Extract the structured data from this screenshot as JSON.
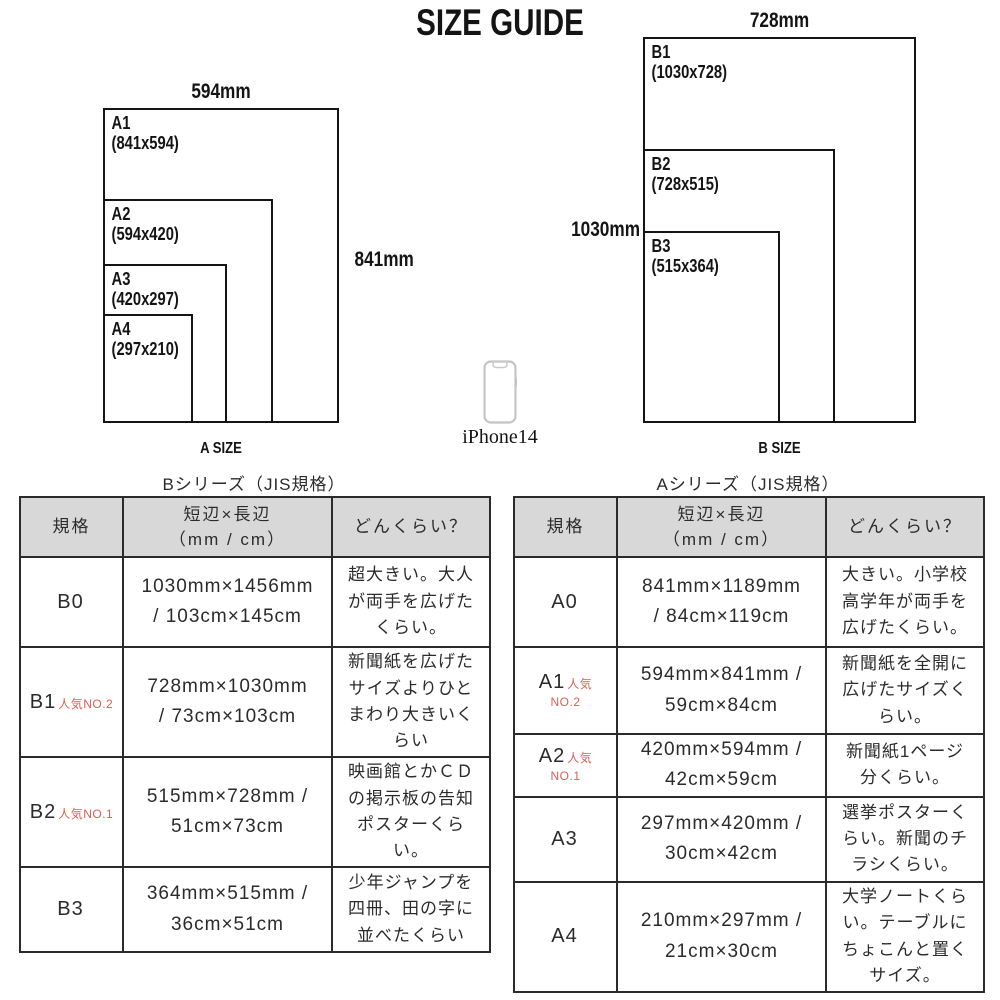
{
  "title": "SIZE GUIDE",
  "colors": {
    "accent_red": "#e05c53",
    "header_bg": "#d8d8d8",
    "border": "#2b2b2b",
    "ink": "#141414",
    "phone_gray": "#c4c4c4"
  },
  "a_diagram": {
    "width_label": "594mm",
    "height_label": "841mm",
    "caption": "A SIZE",
    "rects": [
      {
        "name": "A1",
        "dims": "(841x594)"
      },
      {
        "name": "A2",
        "dims": "(594x420)"
      },
      {
        "name": "A3",
        "dims": "(420x297)"
      },
      {
        "name": "A4",
        "dims": "(297x210)"
      }
    ]
  },
  "b_diagram": {
    "width_label": "728mm",
    "height_label": "1030mm",
    "caption": "B SIZE",
    "rects": [
      {
        "name": "B1",
        "dims": "(1030x728)"
      },
      {
        "name": "B2",
        "dims": "(728x515)"
      },
      {
        "name": "B3",
        "dims": "(515x364)"
      }
    ]
  },
  "phone": {
    "label": "iPhone14"
  },
  "tables": {
    "b": {
      "title": "Bシリーズ（JIS規格）",
      "headers": {
        "col1": "規格",
        "col2": "短辺×長辺\n（mm / cm）",
        "col3": "どんくらい？"
      },
      "rows": [
        {
          "label": "B0",
          "popular": "",
          "popular2": "",
          "size": "1030mm×1456mm\n/ 103cm×145cm",
          "desc": "超大きい。大人\nが両手を広げた\nくらい。"
        },
        {
          "label": "B1",
          "popular": "人気NO.2",
          "popular2": "",
          "size": "728mm×1030mm\n/ 73cm×103cm",
          "desc": "新聞紙を広げた\nサイズよりひと\nまわり大きいく\nらい"
        },
        {
          "label": "B2",
          "popular": "人気NO.1",
          "popular2": "",
          "size": "515mm×728mm /\n51cm×73cm",
          "desc": "映画館とかＣＤ\nの掲示板の告知\nポスターくら\nい。"
        },
        {
          "label": "B3",
          "popular": "",
          "popular2": "",
          "size": "364mm×515mm /\n36cm×51cm",
          "desc": "少年ジャンプを\n四冊、田の字に\n並べたくらい"
        }
      ]
    },
    "a": {
      "title": "Aシリーズ（JIS規格）",
      "headers": {
        "col1": "規格",
        "col2": "短辺×長辺\n（mm / cm）",
        "col3": "どんくらい？"
      },
      "rows": [
        {
          "label": "A0",
          "popular": "",
          "popular2": "",
          "size": "841mm×1189mm\n/ 84cm×119cm",
          "desc": "大きい。小学校\n高学年が両手を\n広げたくらい。"
        },
        {
          "label": "A1",
          "popular": "人気",
          "popular2": "NO.2",
          "size": "594mm×841mm /\n59cm×84cm",
          "desc": "新聞紙を全開に\n広げたサイズく\nらい。"
        },
        {
          "label": "A2",
          "popular": "人気",
          "popular2": "NO.1",
          "size": "420mm×594mm /\n42cm×59cm",
          "desc": "新聞紙1ページ\n分くらい。"
        },
        {
          "label": "A3",
          "popular": "",
          "popular2": "",
          "size": "297mm×420mm /\n30cm×42cm",
          "desc": "選挙ポスターく\nらい。新聞のチ\nラシくらい。"
        },
        {
          "label": "A4",
          "popular": "",
          "popular2": "",
          "size": "210mm×297mm /\n21cm×30cm",
          "desc": "大学ノートくら\nい。テーブルに\nちょこんと置く\nサイズ。"
        }
      ]
    }
  }
}
